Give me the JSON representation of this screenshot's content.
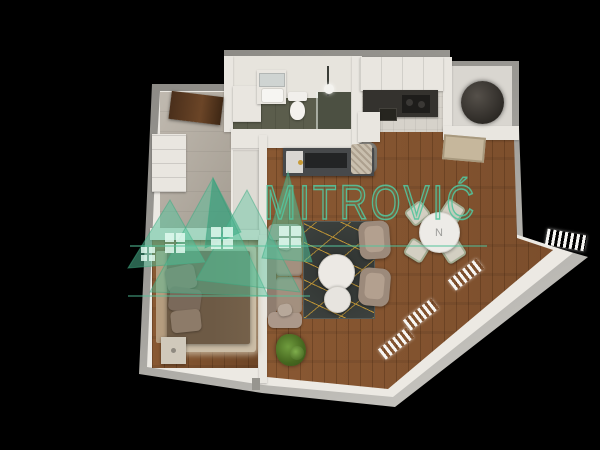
{
  "scene": {
    "background_color": "#000000",
    "description": "3D top-down render of a one-bedroom apartment floor plan on black"
  },
  "watermark": {
    "brand_text": "MITROVIĆ",
    "logo_icon": "mountain-peaks-windows-logo-icon",
    "accent_color": "#53c49c"
  },
  "floorplan": {
    "dining_table_marker": "N",
    "colors": {
      "background": "#000000",
      "outer_wall": "#908e89",
      "outer_wall_light": "#c9c7c2",
      "interior_wall": "#e9e6e0",
      "wood_living": "#8a5731",
      "wood_bedroom": "#7c4e2b",
      "hall_floor": "#b2aa9e",
      "bath_floor_tile": "#5b5d4c",
      "shower_tile": "#4c5042",
      "kitchen_tile": "#d6d2ca",
      "niche_floor": "#d9d6d0",
      "counter_dark": "#34322e",
      "rug_dark": "#3d423f",
      "rug_gold": "#c79a36",
      "sofa": "#a3907f",
      "bed": "#6d5a45",
      "bed_rug": "#cbbda6",
      "plant_green": "#55802f",
      "boiler": "#3e3933",
      "door_wood": "#5a3a22",
      "dining_chair": "#d3cfc2",
      "chair_trim": "#a3ad93"
    }
  }
}
